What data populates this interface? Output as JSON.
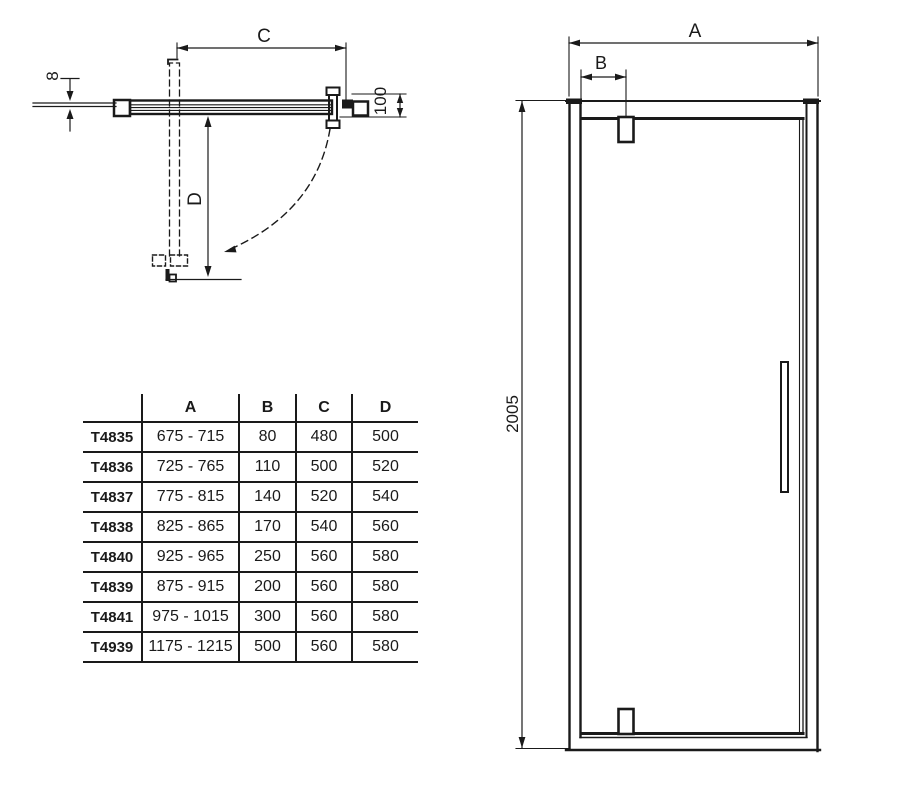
{
  "colors": {
    "line": "#1a1a1a",
    "background": "#ffffff"
  },
  "drawing": {
    "plan_view": {
      "labels": {
        "glass_thickness": "8",
        "width_c": "C",
        "depth_d": "D",
        "profile_depth": "100"
      }
    },
    "front_view": {
      "labels": {
        "width_a": "A",
        "hinge_offset_b": "B",
        "height": "2005"
      }
    }
  },
  "table": {
    "headers": {
      "model": "",
      "a": "A",
      "b": "B",
      "c": "C",
      "d": "D"
    },
    "rows": [
      {
        "model": "T4835",
        "a": "675 - 715",
        "b": "80",
        "c": "480",
        "d": "500"
      },
      {
        "model": "T4836",
        "a": "725 - 765",
        "b": "110",
        "c": "500",
        "d": "520"
      },
      {
        "model": "T4837",
        "a": "775 - 815",
        "b": "140",
        "c": "520",
        "d": "540"
      },
      {
        "model": "T4838",
        "a": "825 - 865",
        "b": "170",
        "c": "540",
        "d": "560"
      },
      {
        "model": "T4840",
        "a": "925 - 965",
        "b": "250",
        "c": "560",
        "d": "580"
      },
      {
        "model": "T4839",
        "a": "875 - 915",
        "b": "200",
        "c": "560",
        "d": "580"
      },
      {
        "model": "T4841",
        "a": "975 - 1015",
        "b": "300",
        "c": "560",
        "d": "580"
      },
      {
        "model": "T4939",
        "a": "1175 - 1215",
        "b": "500",
        "c": "560",
        "d": "580"
      }
    ]
  }
}
